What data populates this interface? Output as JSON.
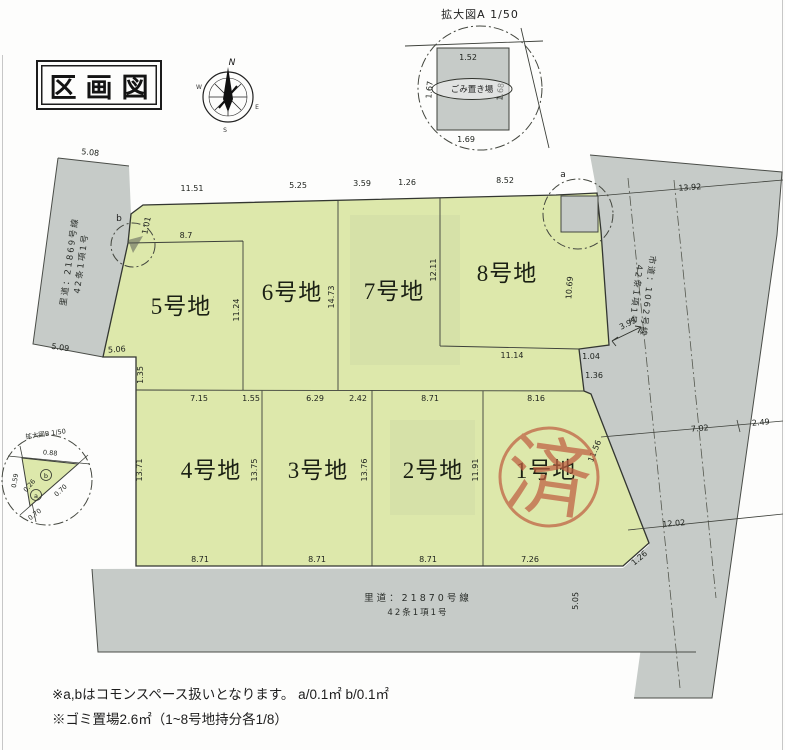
{
  "page": {
    "title": "区画図"
  },
  "compass": {
    "north": "N",
    "south": "S",
    "east": "E",
    "west": "W"
  },
  "detail_a": {
    "title": "拡大図A 1/50",
    "garbage_label": "ごみ置き場",
    "dim_top": "1.52",
    "dim_bottom": "1.69",
    "dim_left": "1.67",
    "dim_right": "1.68"
  },
  "detail_b": {
    "title": "拡大図B 1/50",
    "dim_top": "0.88",
    "dim_hyp": "0.70",
    "dim_bottom": "0.70",
    "dim_left": "0.59",
    "dim_inner": "0.26",
    "marker_a": "a",
    "marker_b": "b"
  },
  "lots": {
    "lot1": {
      "label": "1号地",
      "dim_top": "8.16",
      "dim_bottom": "7.26",
      "dim_right": "11.56",
      "dim_corner": "1.26"
    },
    "lot2": {
      "label": "2号地",
      "dim_top": "8.71",
      "dim_bottom": "8.71",
      "dim_right": "11.91"
    },
    "lot3": {
      "label": "3号地",
      "dim_top_a": "6.29",
      "dim_top_b": "2.42",
      "dim_bottom": "8.71",
      "dim_right": "13.76"
    },
    "lot4": {
      "label": "4号地",
      "dim_top_a": "7.15",
      "dim_top_b": "1.55",
      "dim_bottom": "8.71",
      "dim_left": "13.71",
      "dim_right": "13.75"
    },
    "lot5": {
      "label": "5号地",
      "dim_top": "8.7",
      "dim_right": "11.24",
      "dim_bottom": "5.06",
      "dim_step": "1.35"
    },
    "lot6": {
      "label": "6号地",
      "dim_top_a": "11.51",
      "dim_top_b": "5.25",
      "dim_right": "14.73"
    },
    "lot7": {
      "label": "7号地",
      "dim_top_a": "3.59",
      "dim_top_b": "1.26",
      "dim_right": "12.11"
    },
    "lot8": {
      "label": "8号地",
      "dim_top": "8.52",
      "dim_bottom": "11.14",
      "dim_right": "10.69",
      "dim_edge_a": "1.04",
      "dim_edge_b": "1.36"
    }
  },
  "roads": {
    "left": {
      "name": "里道：21869号線",
      "article": "42条1項1号",
      "dim_top": "5.08",
      "dim_bottom": "5.09"
    },
    "right": {
      "name": "市道：1062号線",
      "article": "42条1項1号",
      "dim_top": "13.92",
      "dim_a": "7.02",
      "dim_b": "2.49",
      "dim_c": "12.02",
      "dim_width": "3.95"
    },
    "bottom": {
      "name": "里道：21870号線",
      "article": "42条1項1号",
      "dim_height": "5.05"
    }
  },
  "markers": {
    "a": "a",
    "b": "b",
    "b_dim": "1.01"
  },
  "stamp": {
    "text": "済"
  },
  "colors": {
    "parcel_green": "#dde8ab",
    "road_gray": "#c6cbc8",
    "stamp_red": "#bf5f41",
    "line": "#3a3d38"
  },
  "notes": {
    "line1": "※a,bはコモンスペース扱いとなります。 a/0.1㎡  b/0.1㎡",
    "line2": "※ゴミ置場2.6㎡（1~8号地持分各1/8）"
  }
}
